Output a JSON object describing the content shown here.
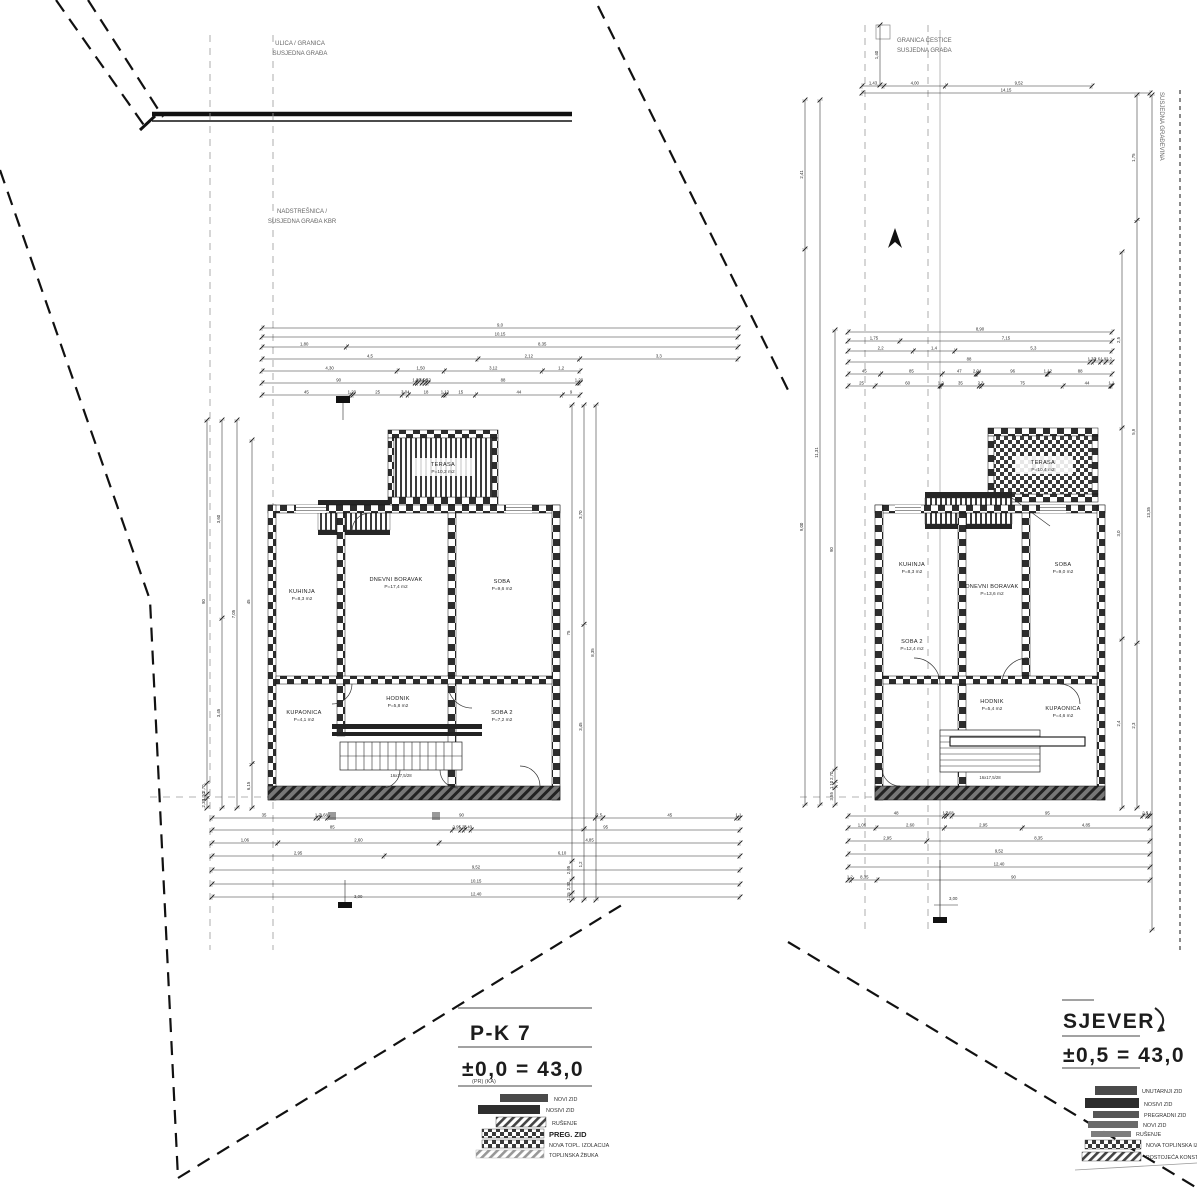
{
  "drawing": {
    "left": {
      "site_label_top": {
        "line1": "ULICA / GRANICA",
        "line2": "SUSJEDNA GRAĐA"
      },
      "site_label_mid": {
        "line1": "NADSTREŠNICA /",
        "line2": "SUSJEDNA GRAĐA KBR"
      },
      "terrace": {
        "name": "TERASA",
        "area": "P=10,2 m2"
      },
      "stairs_note": "16x17,5/28",
      "benchmark": "3,00",
      "rooms": [
        {
          "name": "KUHINJA",
          "area": "P=8,3 m2"
        },
        {
          "name": "DNEVNI BORAVAK",
          "area": "P=17,4 m2"
        },
        {
          "name": "SOBA",
          "area": "P=9,6 m2"
        },
        {
          "name": "KUPAONICA",
          "area": "P=4,1 m2"
        },
        {
          "name": "HODNIK",
          "area": "P=5,8 m2"
        },
        {
          "name": "SOBA 2",
          "area": "P=7,2 m2"
        }
      ],
      "title": {
        "line1": "P-K 7",
        "line2": "±0,0 = 43,0",
        "sub": "(PR)        (KA)"
      },
      "legend": [
        {
          "label": "NOVI ZID"
        },
        {
          "label": "NOSIVI ZID"
        },
        {
          "label": "RUŠENJE"
        },
        {
          "label": "PREG. ZID"
        },
        {
          "label": "NOVA TOPL. IZOLACIJA"
        },
        {
          "label": "TOPLINSKA ŽBUKA"
        }
      ]
    },
    "right": {
      "site_label_top": {
        "line1": "GRANICA ČESTICE",
        "line2": "SUSJEDNA GRAĐA"
      },
      "edge_label": "SUSJEDNA GRAĐEVINA",
      "terrace": {
        "name": "TERASA",
        "area": "P=10,4 m2"
      },
      "porch_note": "ULAZ",
      "stairs_note": "16x17,5/28",
      "benchmark": "3,00",
      "rooms": [
        {
          "name": "KUHINJA",
          "area": "P=8,3 m2"
        },
        {
          "name": "DNEVNI BORAVAK",
          "area": "P=13,6 m2"
        },
        {
          "name": "SOBA",
          "area": "P=9,0 m2"
        },
        {
          "name": "SOBA 2",
          "area": "P=12,4 m2"
        },
        {
          "name": "HODNIK",
          "area": "P=5,4 m2"
        },
        {
          "name": "KUPAONICA",
          "area": "P=4,6 m2"
        }
      ],
      "title": {
        "line1": "SJEVER",
        "line2": "±0,5 = 43,0"
      },
      "legend": [
        {
          "label": "UNUTARNJI ZID"
        },
        {
          "label": "NOSIVI ZID"
        },
        {
          "label": "PREGRADNI ZID"
        },
        {
          "label": "NOVI ZID"
        },
        {
          "label": "RUŠENJE"
        },
        {
          "label": "NOVA TOPLINSKA IZOLACIJA"
        },
        {
          "label": "POSTOJEĆA KONSTRUKCIJA"
        }
      ]
    },
    "dims": {
      "lt1": [
        "9,0"
      ],
      "lt2": [
        "10,15"
      ],
      "lt3": [
        "1,80",
        "8,35"
      ],
      "lt4": [
        "4,5",
        "2,12",
        "3,3"
      ],
      "lt5": [
        "4,30",
        "1,50",
        "3,12",
        "1,2"
      ],
      "lt6": [
        "90",
        "1,40",
        "2,64",
        "1,90",
        "1,52",
        "88",
        "1,20"
      ],
      "lt7": [
        "45",
        "1,20",
        "25",
        "3,04",
        "18",
        "1,12",
        "15",
        "44",
        "9"
      ],
      "lb1": [
        "35",
        "1,2",
        "2,68",
        "90",
        "2,5",
        "45",
        "1,1"
      ],
      "lb2": [
        "85",
        "2,95",
        "1,26",
        "2,40",
        "95"
      ],
      "lb3": [
        "1,06",
        "2,60",
        "4,85"
      ],
      "lb4": [
        "2,95",
        "6,10"
      ],
      "lb5": [
        "9,52"
      ],
      "lb6": [
        "10,15"
      ],
      "lb7": [
        "12,40"
      ],
      "lvl1": [
        "90",
        "2,70",
        "1,10",
        "2,35"
      ],
      "lvl2": [
        "3,60",
        "3,45"
      ],
      "lvl3": [
        "7,05"
      ],
      "lvl4": [
        "45",
        "6,15"
      ],
      "lvr1": [
        "75",
        "2,95",
        "2,30",
        "1,15"
      ],
      "lvr2": [
        "3,70",
        "3,45",
        "1,2"
      ],
      "lvr3": [
        "8,35"
      ],
      "rt1": [
        "1,43",
        "4,00",
        "9,52"
      ],
      "rt2": [
        "14,15"
      ],
      "rr1": [
        "8,90"
      ],
      "rr2": [
        "1,75",
        "7,15"
      ],
      "rr3": [
        "2,2",
        "1,4",
        "5,3"
      ],
      "rr4": [
        "88",
        "1,32",
        "2,6",
        "1,9",
        "2,2"
      ],
      "rr5": [
        "45",
        "85",
        "47",
        "2,04",
        "96",
        "1,12",
        "88"
      ],
      "rr6": [
        "25",
        "60",
        "1,2",
        "35",
        "2,3",
        "75",
        "44",
        "1,1"
      ],
      "rb1": [
        "48",
        "1,2",
        "2,68",
        "95",
        "2,5",
        "1,1"
      ],
      "rb2": [
        "1,06",
        "2,60",
        "2,95",
        "4,85"
      ],
      "rb3": [
        "2,95",
        "8,35"
      ],
      "rb4": [
        "9,52"
      ],
      "rb5": [
        "12,40"
      ],
      "rb6": [
        "1,2",
        "8,35",
        "90"
      ],
      "rvl1": [
        "2,41",
        "9,00"
      ],
      "rvl2": [
        "11,31"
      ],
      "rvl3": [
        "90",
        "2,70",
        "1,10",
        "3,55"
      ],
      "rvr1": [
        "2,5",
        "3,0",
        "2,4"
      ],
      "rvr2": [
        "1,75",
        "5,9",
        "2,3"
      ],
      "rvr3": [
        "13,35"
      ],
      "rvt": [
        "1,40"
      ]
    }
  }
}
